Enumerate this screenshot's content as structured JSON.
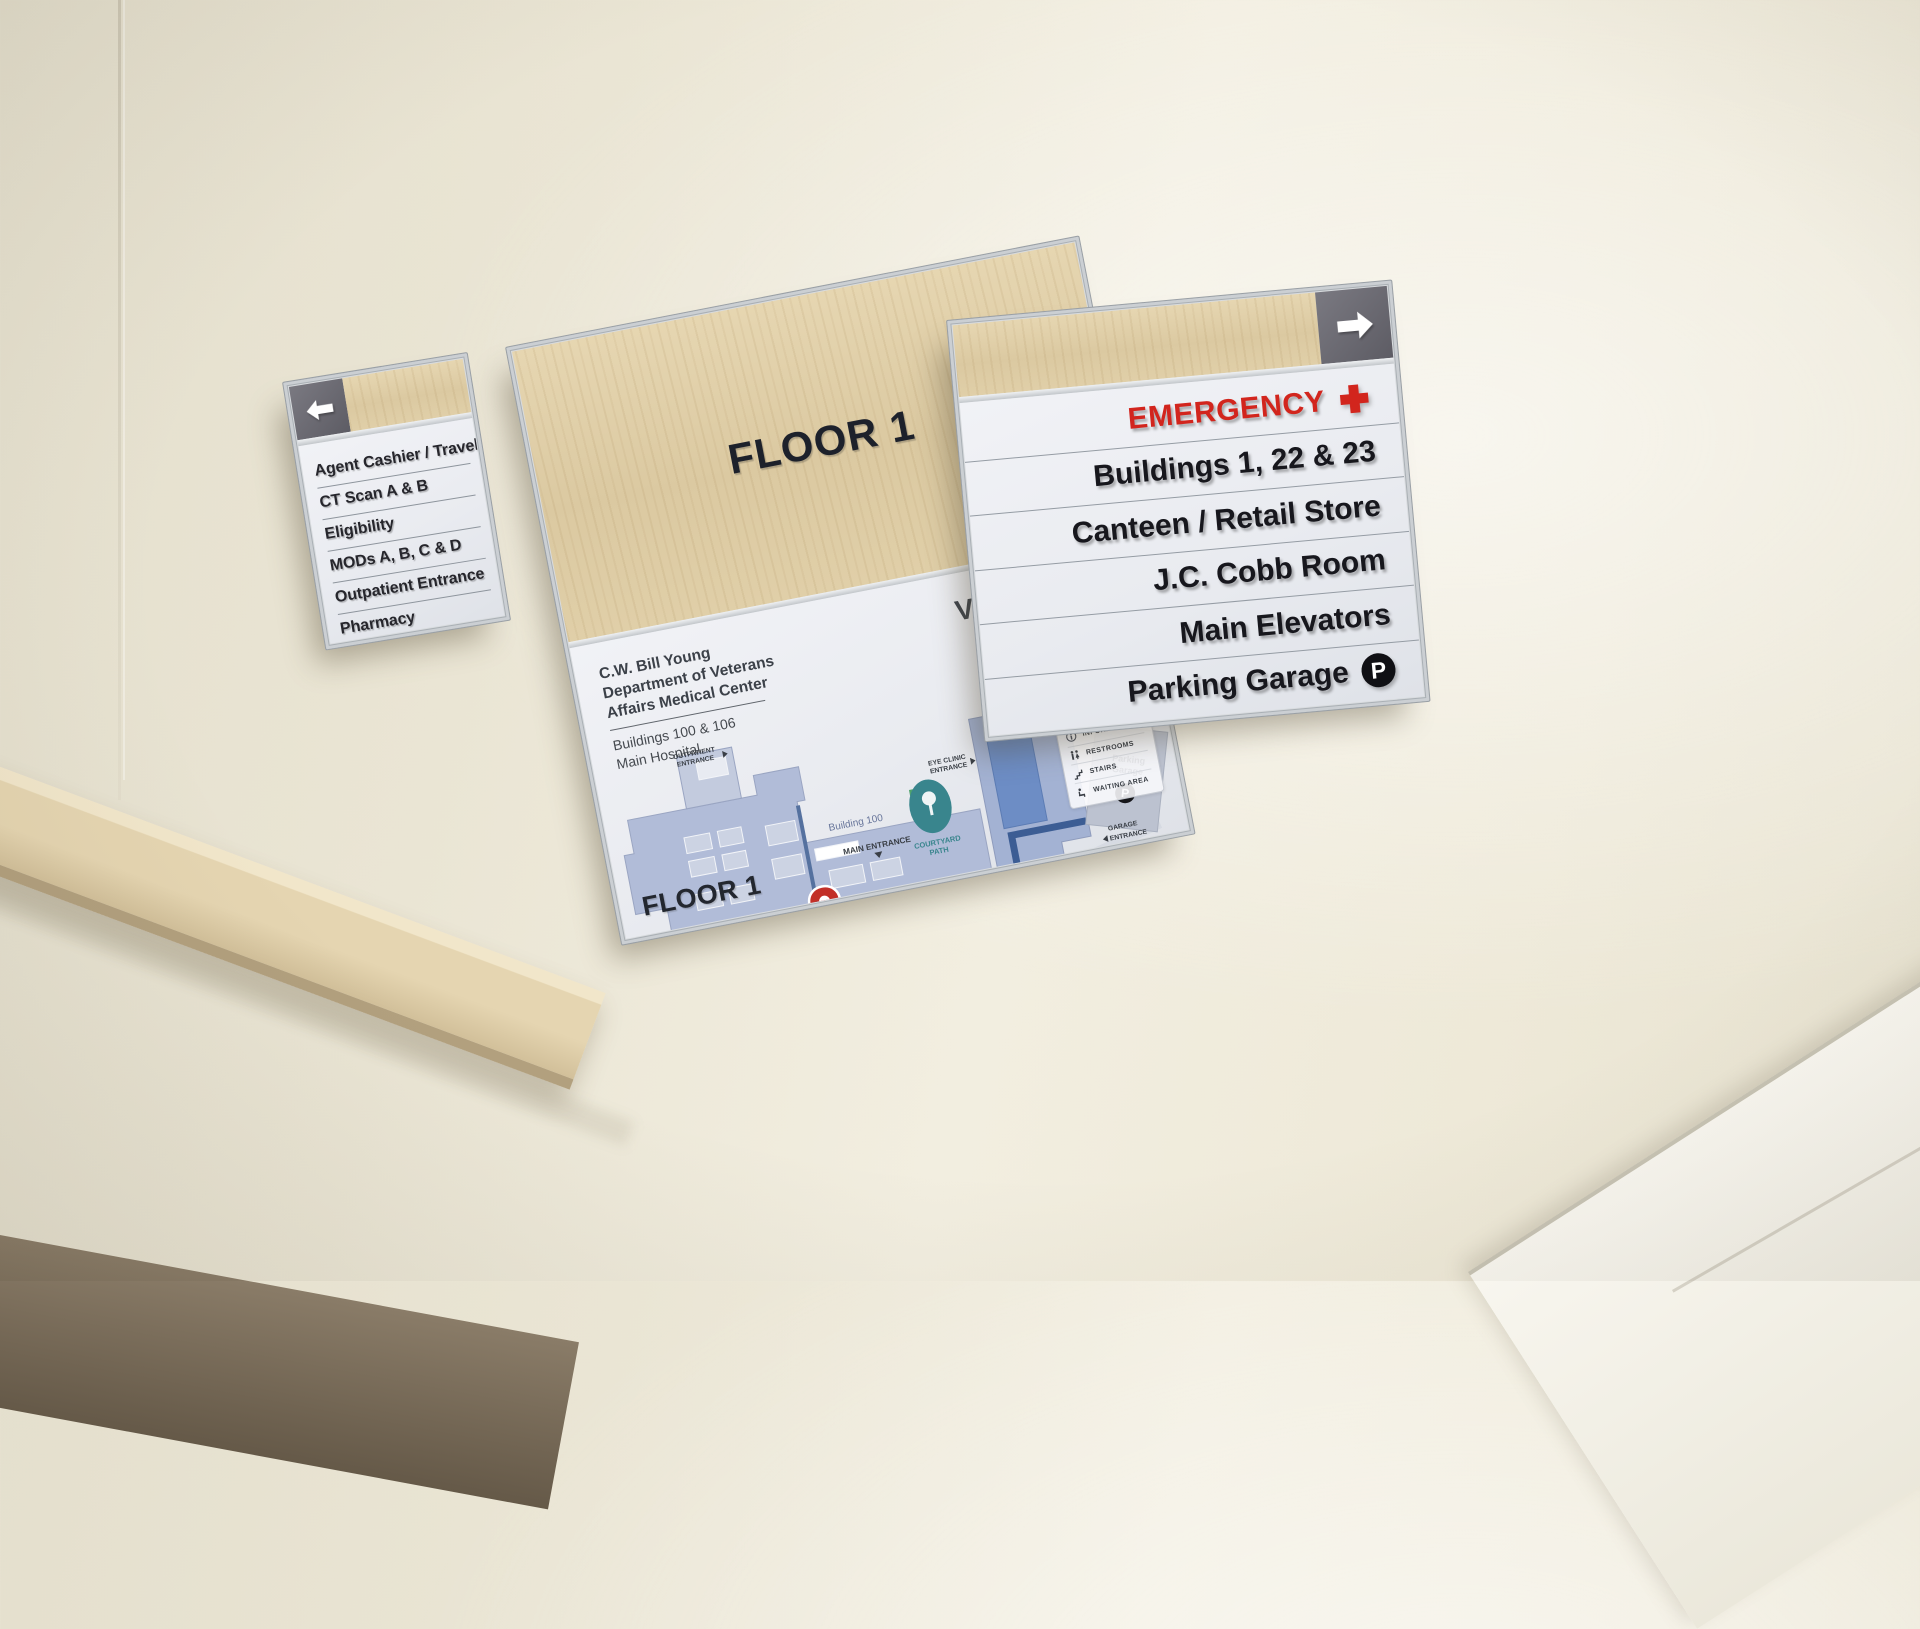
{
  "left_sign": {
    "arrow_icon": "left-arrow-icon",
    "items": [
      "Agent Cashier / Travel",
      "CT Scan A & B",
      "Eligibility",
      "MODs A, B, C & D",
      "Outpatient Entrance",
      "Pharmacy"
    ]
  },
  "center_sign": {
    "header_title": "FLOOR 1",
    "footer_title": "FLOOR 1",
    "facility": {
      "name_line1": "C.W. Bill Young",
      "name_line2": "Department of Veterans",
      "name_line3": "Affairs Medical Center",
      "sub_line1": "Buildings 100 & 106",
      "sub_line2": "Main Hospital"
    },
    "va": {
      "abbr": "VA",
      "dept_line1": "U.S. Department",
      "dept_line2": "of Veterans Affairs"
    },
    "map": {
      "building_100": "Building 100",
      "building_106": "Building 106",
      "main_entrance": "MAIN ENTRANCE",
      "outpatient": [
        "OUTPATIENT",
        "ENTRANCE"
      ],
      "eye_clinic": [
        "EYE CLINIC",
        "ENTRANCE"
      ],
      "garage": [
        "GARAGE",
        "ENTRANCE"
      ],
      "east": [
        "EAST",
        "ENTRANCE"
      ],
      "emergency": [
        "EMERGENCY",
        "ENTRANCE"
      ],
      "courtyard": [
        "COURTYARD",
        "PATH"
      ],
      "parking": [
        "Parking",
        "Garage"
      ],
      "parking_letter": "P",
      "accessible": [
        "Accessible Path to",
        "Buildings 1, 22 & 23"
      ],
      "compass": {
        "n": "N",
        "e": "E",
        "s": "S",
        "w": "W"
      },
      "pin_icon": "you-are-here-pin"
    },
    "legend": {
      "title": "LEGEND",
      "items": [
        {
          "icon": "elevators-icon",
          "label": "ELEVATORS"
        },
        {
          "icon": "entrances-icon",
          "label": "ENTRANCES"
        },
        {
          "icon": "information-icon",
          "label": "INFORMATION"
        },
        {
          "icon": "restrooms-icon",
          "label": "RESTROOMS"
        },
        {
          "icon": "stairs-icon",
          "label": "STAIRS"
        },
        {
          "icon": "waiting-area-icon",
          "label": "WAITING AREA"
        }
      ]
    }
  },
  "right_sign": {
    "arrow_icon": "right-arrow-icon",
    "rows": [
      {
        "label": "EMERGENCY",
        "icon": "emergency-cross-icon"
      },
      {
        "label": "Buildings 1, 22 & 23"
      },
      {
        "label": "Canteen / Retail Store"
      },
      {
        "label": "J.C. Cobb Room"
      },
      {
        "label": "Main Elevators"
      },
      {
        "label": "Parking Garage",
        "icon": "parking-badge-icon",
        "badge_letter": "P"
      }
    ]
  },
  "colors": {
    "emergency_red": "#d2251d",
    "wood": "#ddcba4",
    "map_building_blue": "#b1bcd8",
    "map_corridor_blue": "#3c5d94",
    "courtyard_teal": "#39858d",
    "wall_cream": "#eee9d8"
  }
}
